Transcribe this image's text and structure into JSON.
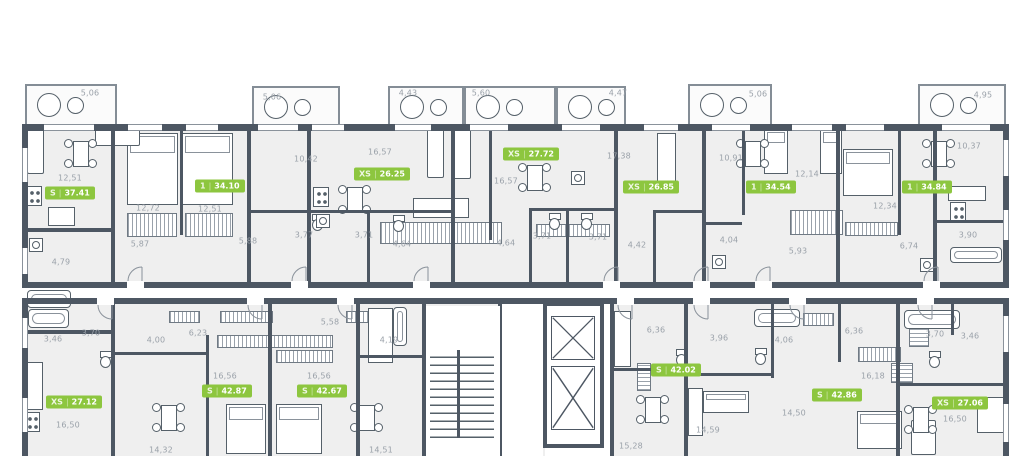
{
  "plan": {
    "title": "residential-floor-plan",
    "wall_color": "#4d5763",
    "floor_color": "#efefef",
    "badge_color": "#8dc63f",
    "dimension_color": "#9aa1a9",
    "badge_separator": "|"
  },
  "apartments": [
    {
      "type": "S",
      "area": "37.41",
      "x": 45,
      "y": 193
    },
    {
      "type": "1",
      "area": "34.10",
      "x": 195,
      "y": 186
    },
    {
      "type": "XS",
      "area": "26.25",
      "x": 354,
      "y": 174
    },
    {
      "type": "XS",
      "area": "27.72",
      "x": 503,
      "y": 154
    },
    {
      "type": "XS",
      "area": "26.85",
      "x": 623,
      "y": 187
    },
    {
      "type": "1",
      "area": "34.54",
      "x": 746,
      "y": 187
    },
    {
      "type": "1",
      "area": "34.84",
      "x": 902,
      "y": 187
    },
    {
      "type": "XS",
      "area": "27.12",
      "x": 46,
      "y": 402
    },
    {
      "type": "S",
      "area": "42.87",
      "x": 202,
      "y": 391
    },
    {
      "type": "S",
      "area": "42.67",
      "x": 297,
      "y": 391
    },
    {
      "type": "S",
      "area": "42.02",
      "x": 651,
      "y": 370
    },
    {
      "type": "S",
      "area": "42.86",
      "x": 812,
      "y": 395
    },
    {
      "type": "XS",
      "area": "27.06",
      "x": 932,
      "y": 403
    }
  ],
  "dimensions": [
    {
      "t": "5,06",
      "x": 90,
      "y": 93
    },
    {
      "t": "5,06",
      "x": 272,
      "y": 97
    },
    {
      "t": "4,43",
      "x": 408,
      "y": 93
    },
    {
      "t": "5,60",
      "x": 481,
      "y": 93
    },
    {
      "t": "4,47",
      "x": 618,
      "y": 93
    },
    {
      "t": "5,06",
      "x": 758,
      "y": 94
    },
    {
      "t": "4,95",
      "x": 983,
      "y": 95
    },
    {
      "t": "12,51",
      "x": 70,
      "y": 178
    },
    {
      "t": "12,72",
      "x": 148,
      "y": 208
    },
    {
      "t": "12,51",
      "x": 210,
      "y": 209
    },
    {
      "t": "10,42",
      "x": 306,
      "y": 159
    },
    {
      "t": "16,57",
      "x": 380,
      "y": 152
    },
    {
      "t": "16,57",
      "x": 506,
      "y": 181
    },
    {
      "t": "17,38",
      "x": 619,
      "y": 156
    },
    {
      "t": "10,91",
      "x": 731,
      "y": 158
    },
    {
      "t": "12,14",
      "x": 807,
      "y": 174
    },
    {
      "t": "12,34",
      "x": 885,
      "y": 206
    },
    {
      "t": "10,37",
      "x": 969,
      "y": 146
    },
    {
      "t": "4,79",
      "x": 61,
      "y": 262
    },
    {
      "t": "5,87",
      "x": 140,
      "y": 244
    },
    {
      "t": "5,88",
      "x": 248,
      "y": 241
    },
    {
      "t": "3,77",
      "x": 304,
      "y": 235
    },
    {
      "t": "3,71",
      "x": 364,
      "y": 235
    },
    {
      "t": "4,64",
      "x": 402,
      "y": 244
    },
    {
      "t": "4,64",
      "x": 506,
      "y": 243
    },
    {
      "t": "3,71",
      "x": 542,
      "y": 236
    },
    {
      "t": "3,71",
      "x": 598,
      "y": 237
    },
    {
      "t": "4,42",
      "x": 637,
      "y": 245
    },
    {
      "t": "4,04",
      "x": 729,
      "y": 240
    },
    {
      "t": "5,93",
      "x": 798,
      "y": 251
    },
    {
      "t": "6,74",
      "x": 909,
      "y": 246
    },
    {
      "t": "3,90",
      "x": 968,
      "y": 235
    },
    {
      "t": "3,46",
      "x": 53,
      "y": 339
    },
    {
      "t": "3,70",
      "x": 91,
      "y": 333
    },
    {
      "t": "4,00",
      "x": 156,
      "y": 340
    },
    {
      "t": "6,23",
      "x": 198,
      "y": 333
    },
    {
      "t": "5,58",
      "x": 330,
      "y": 322
    },
    {
      "t": "4,19",
      "x": 389,
      "y": 340
    },
    {
      "t": "16,56",
      "x": 225,
      "y": 376
    },
    {
      "t": "16,56",
      "x": 319,
      "y": 376
    },
    {
      "t": "16,50",
      "x": 68,
      "y": 425
    },
    {
      "t": "14,32",
      "x": 161,
      "y": 450
    },
    {
      "t": "14,51",
      "x": 381,
      "y": 450
    },
    {
      "t": "6,36",
      "x": 656,
      "y": 330
    },
    {
      "t": "15,28",
      "x": 631,
      "y": 446
    },
    {
      "t": "3,96",
      "x": 719,
      "y": 338
    },
    {
      "t": "14,59",
      "x": 708,
      "y": 430
    },
    {
      "t": "4,06",
      "x": 784,
      "y": 340
    },
    {
      "t": "6,36",
      "x": 854,
      "y": 331
    },
    {
      "t": "16,18",
      "x": 873,
      "y": 376
    },
    {
      "t": "14,50",
      "x": 794,
      "y": 413
    },
    {
      "t": "3,70",
      "x": 935,
      "y": 334
    },
    {
      "t": "3,46",
      "x": 970,
      "y": 336
    },
    {
      "t": "16,50",
      "x": 955,
      "y": 419
    }
  ]
}
